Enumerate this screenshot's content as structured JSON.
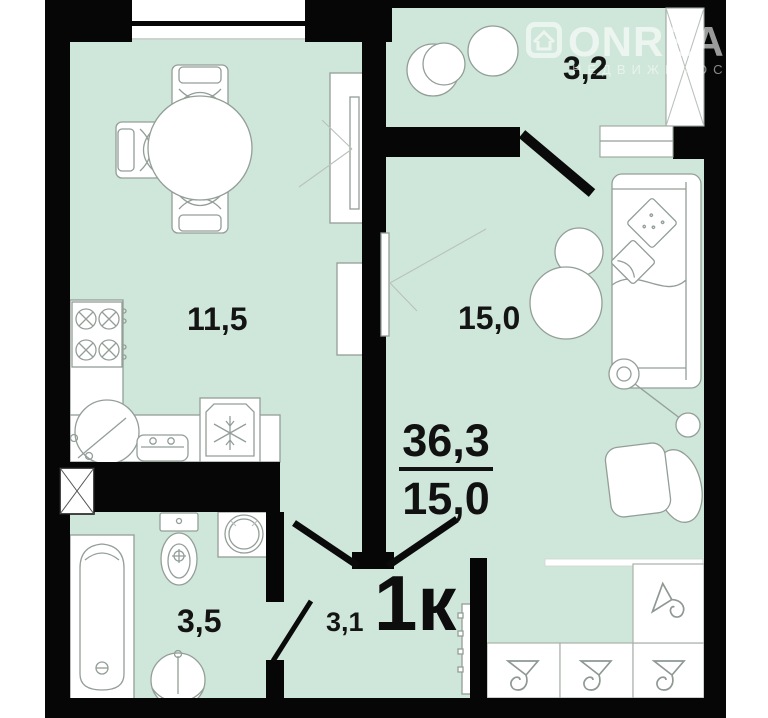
{
  "plan": {
    "apartment_type_label": "1к",
    "area_summary": {
      "total": "36,3",
      "living": "15,0"
    },
    "rooms": {
      "kitchen": "11,5",
      "living_room": "15,0",
      "balcony": "3,2",
      "bathroom": "3,5",
      "hallway": "3,1"
    }
  },
  "watermark": {
    "brand": "ONREALT",
    "subtitle": "НЕДВИЖИМОСТЬ"
  },
  "colors": {
    "room_fill": "#cfe7da",
    "wall": "#060606",
    "furniture_outline": "#939e97",
    "label_text": "#141414",
    "watermark_text": "rgba(255,255,255,0.6)"
  }
}
